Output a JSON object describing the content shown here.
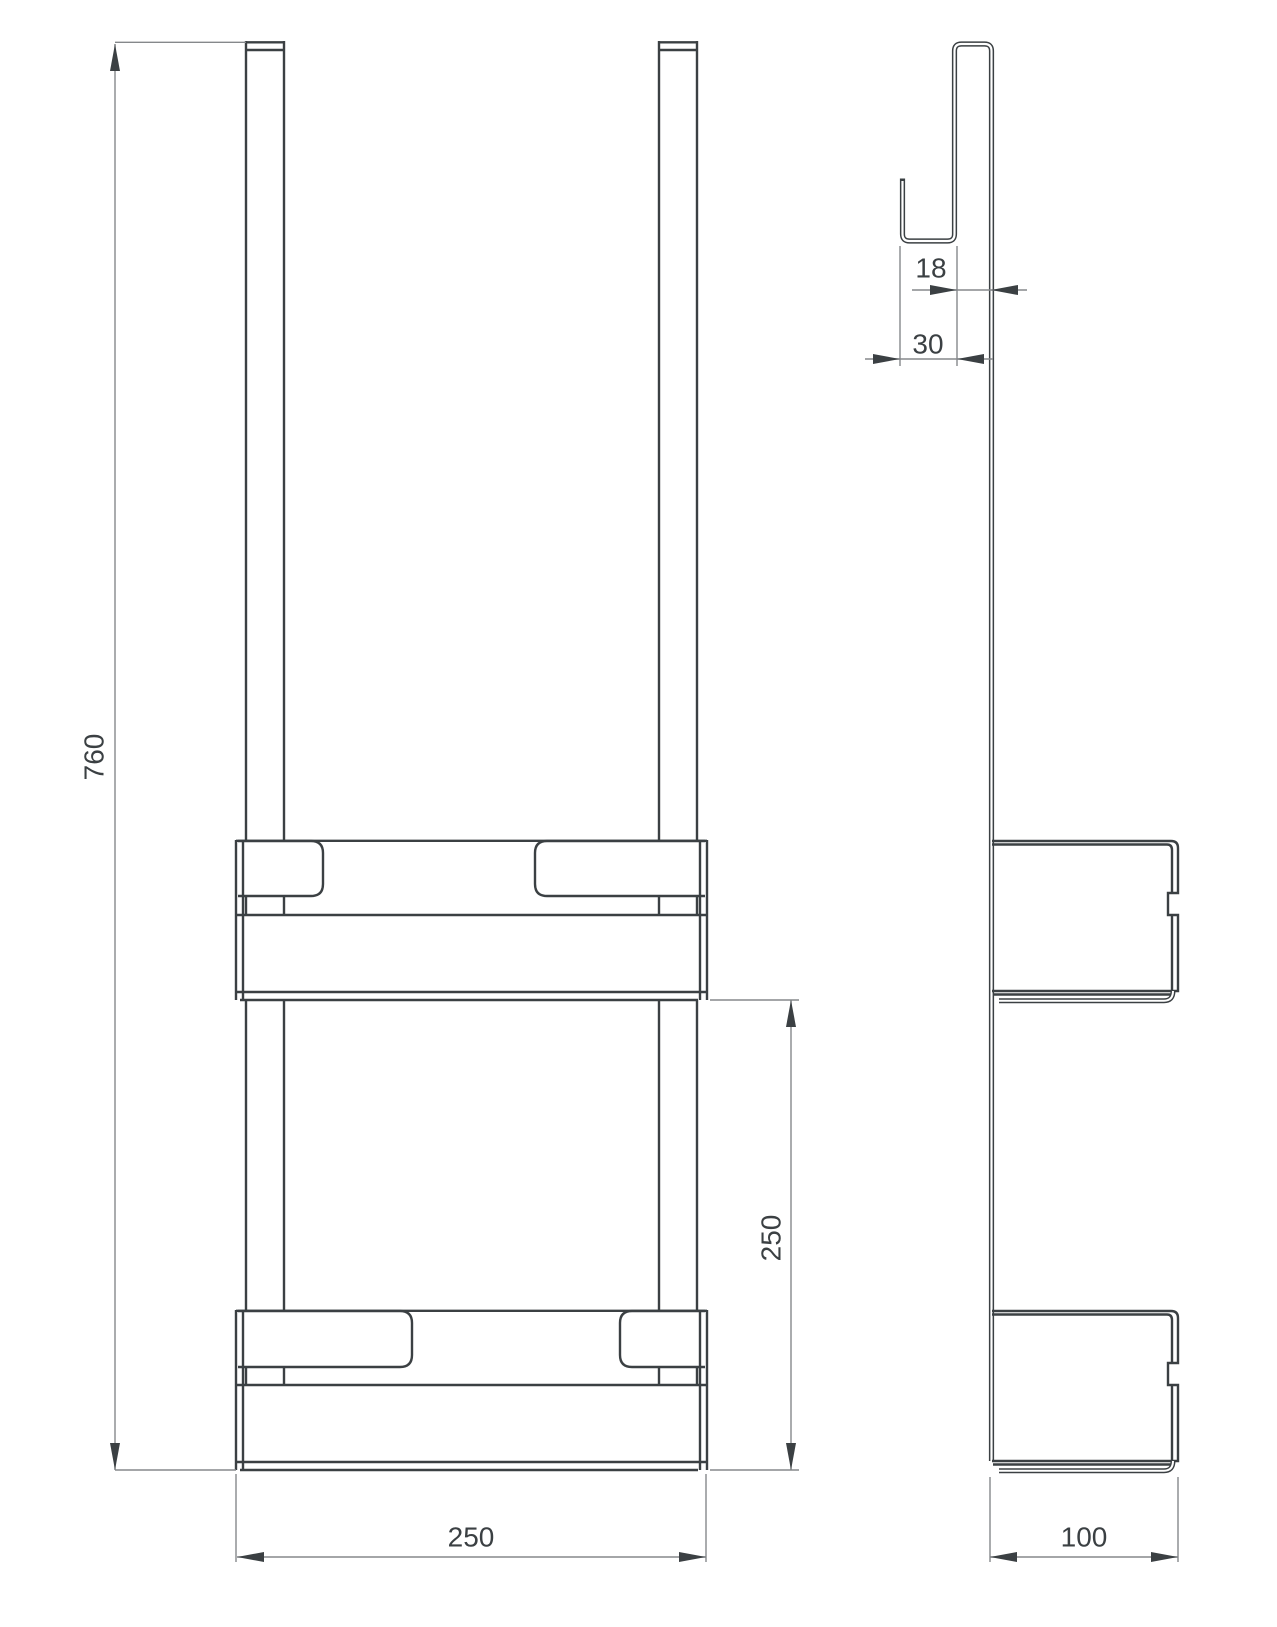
{
  "colors": {
    "object_line": "#3b4043",
    "dimension_line": "#85888b",
    "text": "#3b4043",
    "background": "#ffffff"
  },
  "dimensions": {
    "front": {
      "overall_height": "760",
      "shelf_spacing": "250",
      "width": "250"
    },
    "side": {
      "hook_opening": "18",
      "hook_width": "30",
      "depth": "100"
    }
  }
}
